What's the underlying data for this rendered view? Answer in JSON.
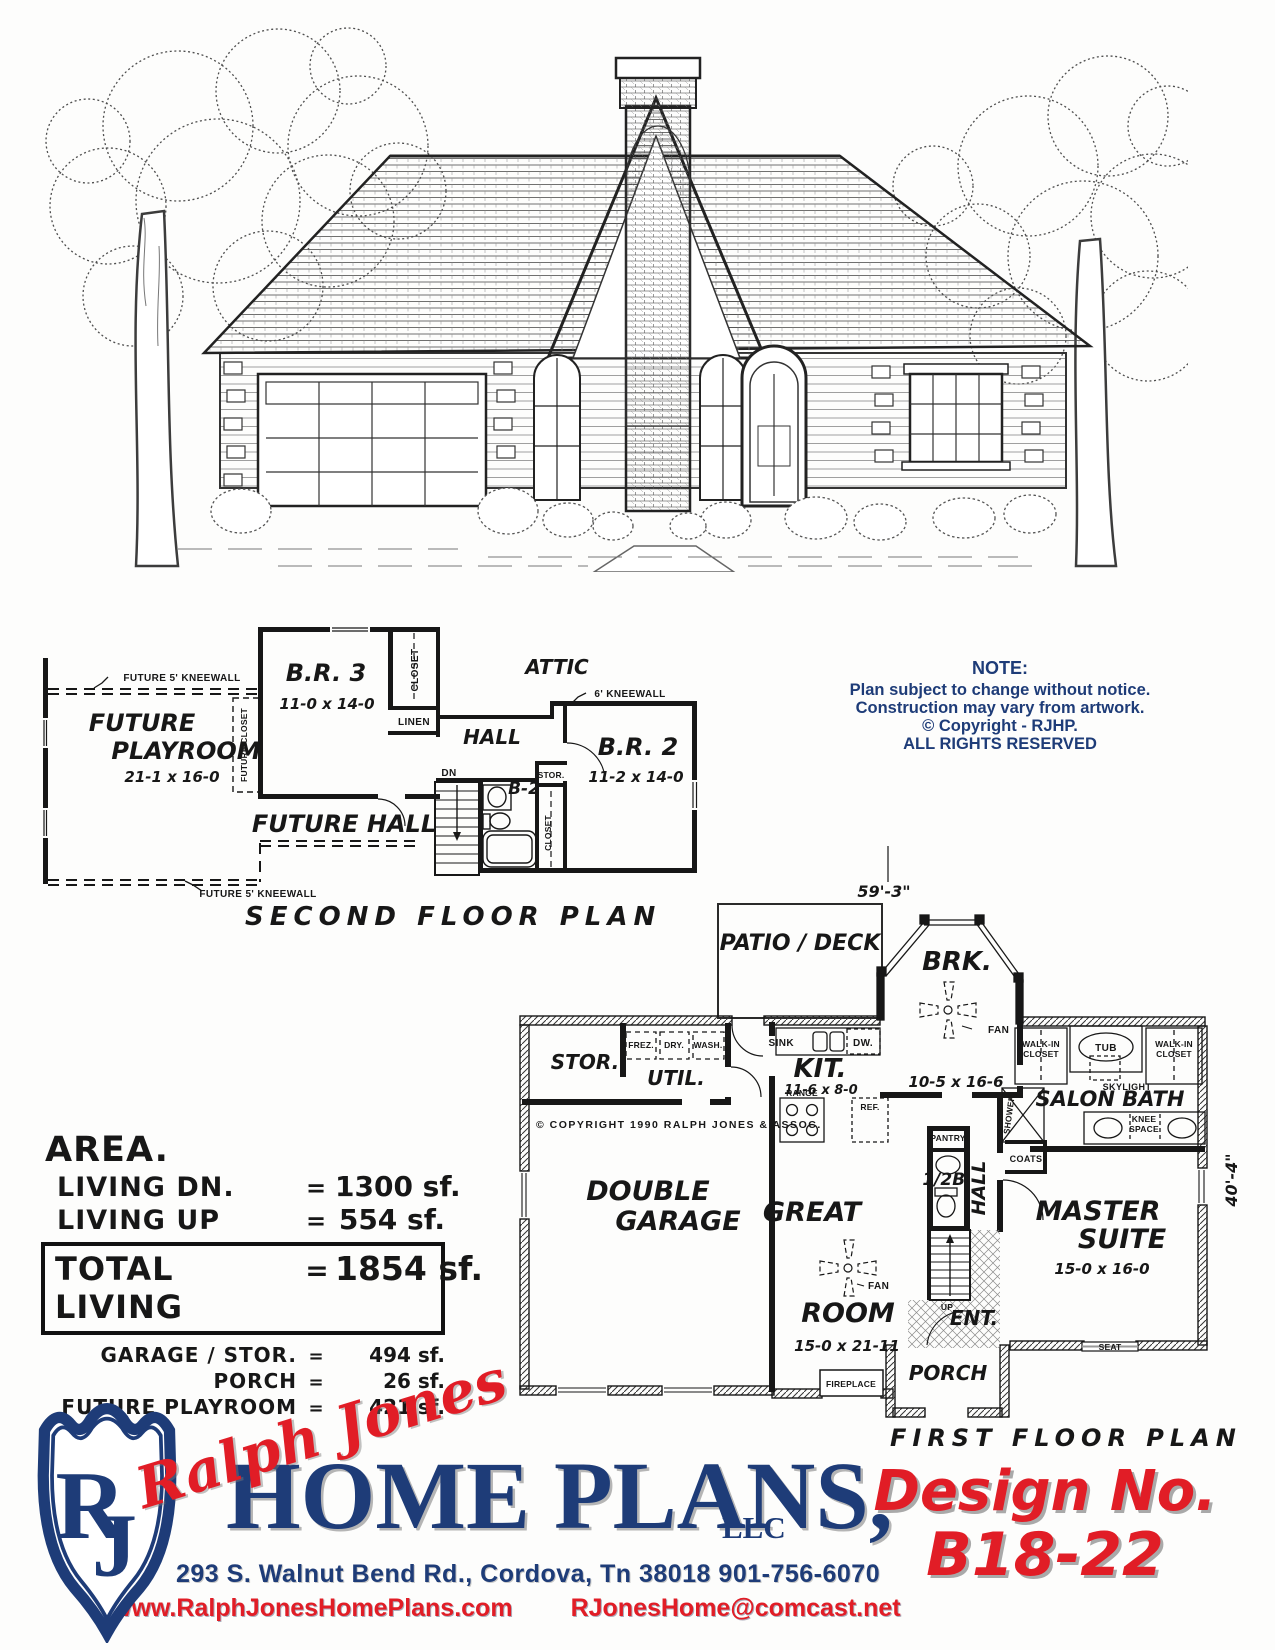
{
  "colors": {
    "navy": "#1e3c78",
    "red": "#e11d26",
    "ink": "#171717"
  },
  "note": {
    "heading": "NOTE:",
    "lines": [
      "Plan subject to change without notice.",
      "Construction may vary from artwork.",
      "©   Copyright - RJHP.",
      "ALL RIGHTS RESERVED"
    ]
  },
  "second_floor": {
    "title": "SECOND FLOOR PLAN",
    "kneewall_top": "FUTURE 5' KNEEWALL",
    "kneewall_bottom": "FUTURE 5' KNEEWALL",
    "kneewall6": "6' KNEEWALL",
    "future1": "FUTURE",
    "future2": "PLAYROOM",
    "playroom_dim": "21-1 x 16-0",
    "future_closet": "FUTURE CLOSET",
    "br3": "B.R. 3",
    "br3_dim": "11-0 x 14-0",
    "closet": "CLOSET",
    "linen": "LINEN",
    "hall": "HALL",
    "attic": "ATTIC",
    "br2": "B.R. 2",
    "br2_dim": "11-2 x 14-0",
    "dn": "DN",
    "b2": "B-2",
    "stor": "STOR.",
    "closet2": "CLOSET",
    "future_hall": "FUTURE HALL"
  },
  "first_floor": {
    "title": "FIRST FLOOR PLAN",
    "dim_width": "59'-3\"",
    "dim_height": "40'-4\"",
    "patio": "PATIO / DECK",
    "brk": "BRK.",
    "brk_dim": "10-5 x 16-6",
    "fan": "FAN",
    "fan2": "FAN",
    "stor": "STOR.",
    "frez": "FREZ.",
    "dry": "DRY.",
    "wash": "WASH.",
    "util": "UTIL.",
    "sink": "SINK",
    "dw": "DW.",
    "kit": "KIT.",
    "kit_dim": "11-6 x 8-0",
    "range": "RANGE",
    "ref": "REF.",
    "copyright": "© COPYRIGHT 1990 RALPH JONES & ASSOC.",
    "walkin1a": "WALK-IN",
    "walkin1b": "CLOSET",
    "tub": "TUB",
    "walkin2a": "WALK-IN",
    "walkin2b": "CLOSET",
    "shower": "SHOWER",
    "skylight": "SKYLIGHT",
    "salon_bath": "SALON BATH",
    "knee1": "KNEE",
    "knee2": "SPACE",
    "coats": "COATS",
    "pantry": "PANTRY",
    "half_bath": "1/2B.",
    "hall": "HALL",
    "garage1": "DOUBLE",
    "garage2": "GARAGE",
    "great1": "GREAT",
    "great2": "ROOM",
    "great_dim": "15-0 x 21-11",
    "master1": "MASTER",
    "master2": "SUITE",
    "master_dim": "15-0 x 16-0",
    "up": "UP",
    "ent": "ENT.",
    "seat": "SEAT",
    "fireplace": "FIREPLACE",
    "porch": "PORCH"
  },
  "area": {
    "heading": "AREA.",
    "equals": "=",
    "rows": [
      {
        "label": "LIVING   DN.",
        "value": "1300 sf."
      },
      {
        "label": "LIVING   UP",
        "value": "554 sf."
      }
    ],
    "total_label": "TOTAL  LIVING",
    "total_value": "1854 sf.",
    "sub_rows": [
      {
        "label": "GARAGE / STOR.",
        "value": "494 sf."
      },
      {
        "label": "PORCH",
        "value": "26 sf."
      },
      {
        "label": "FUTURE  PLAYROOM",
        "value": "421 sf."
      }
    ]
  },
  "footer": {
    "monogram": "RJ",
    "script_name": "Ralph Jones",
    "company": "HOME PLANS,",
    "company_suffix": "LLC",
    "address": "293 S. Walnut Bend  Rd., Cordova, Tn  38018   901-756-6070",
    "website": "www.RalphJonesHomePlans.com",
    "email": "RJonesHome@comcast.net",
    "design_label": "Design No.",
    "design_number": "B18-22"
  }
}
